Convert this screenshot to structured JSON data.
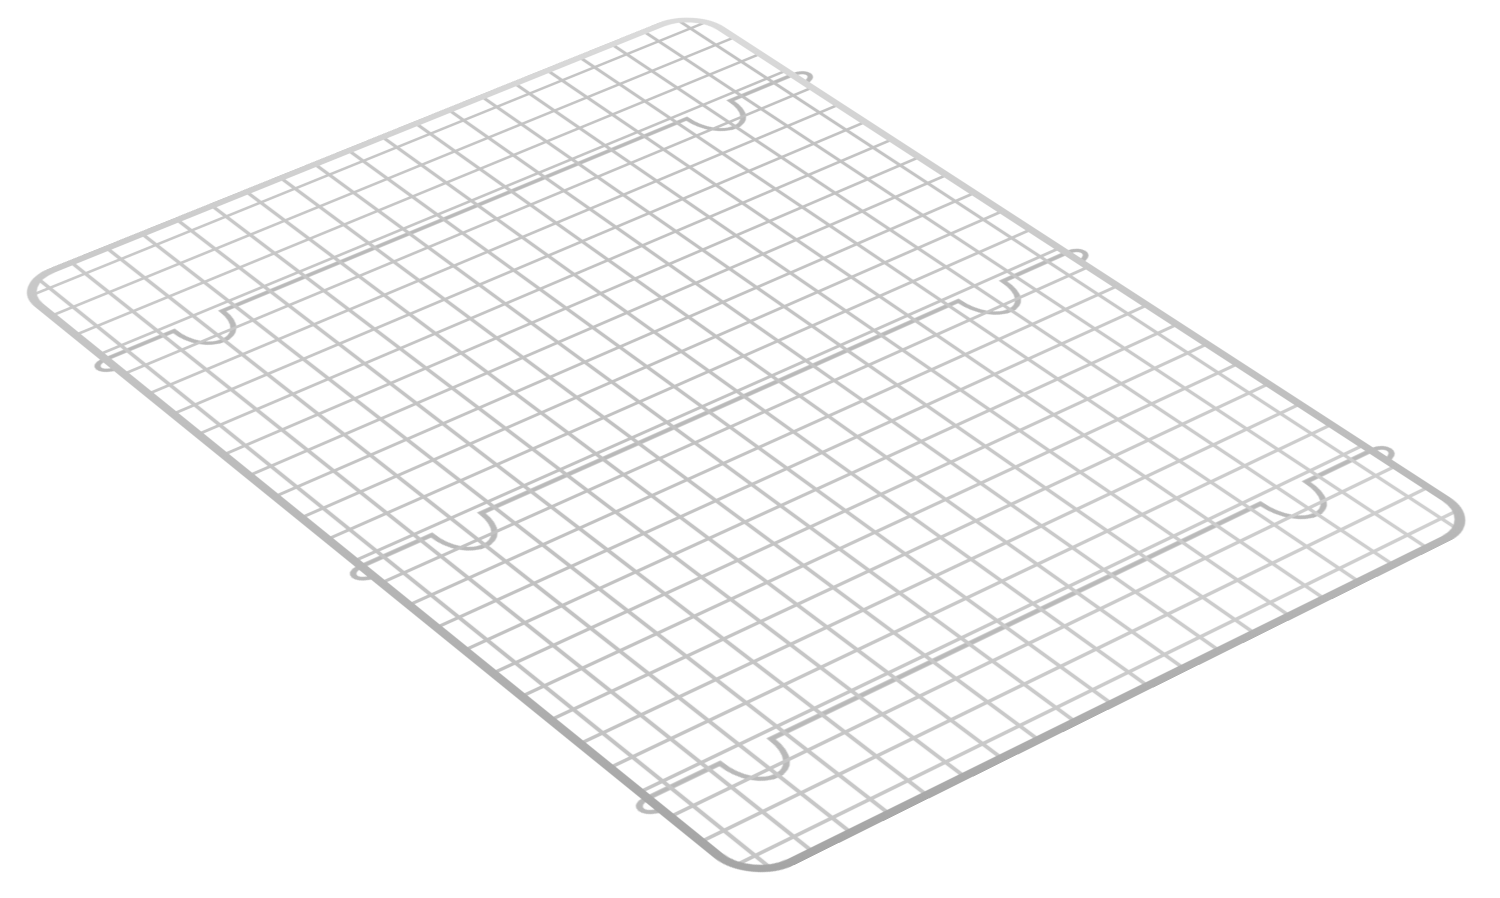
{
  "scene": {
    "description": "Product photo of a silver stainless-steel wire cooling and baking rack with rounded corners, photographed at a three-quarter perspective angle on a plain white background",
    "background_color": "#ffffff"
  },
  "rack": {
    "material": "stainless-steel-wire",
    "columns": 21,
    "rows": 28,
    "cell_size": 40,
    "edge_margin": 28,
    "flat_width": 816,
    "flat_height": 1096,
    "frame_thickness": 9,
    "wire_thickness": 4.2,
    "bar_thickness": 5.5,
    "corner_radius": 42,
    "frame_gradient": [
      "#dcdcdc",
      "#c0c0c0",
      "#a4a4a4"
    ],
    "wire_gradient": [
      "#cacaca",
      "#c1c1c1",
      "#d0d0d0"
    ],
    "bar_color": "#b9b9b9",
    "corners_screen": {
      "top_left": [
        8,
        285
      ],
      "top_right": [
        695,
        8
      ],
      "bottom_left": [
        750,
        887
      ],
      "bottom_right": [
        1488,
        522
      ]
    },
    "support_bars": [
      {
        "y": 158,
        "feet_x": [
          107,
          707
        ]
      },
      {
        "y": 558,
        "feet_x": [
          107,
          707
        ]
      },
      {
        "y": 958,
        "feet_x": [
          107,
          707
        ]
      }
    ],
    "foot_half_width": 27,
    "foot_depth_ctrl": 54,
    "hook_drop": 18
  }
}
